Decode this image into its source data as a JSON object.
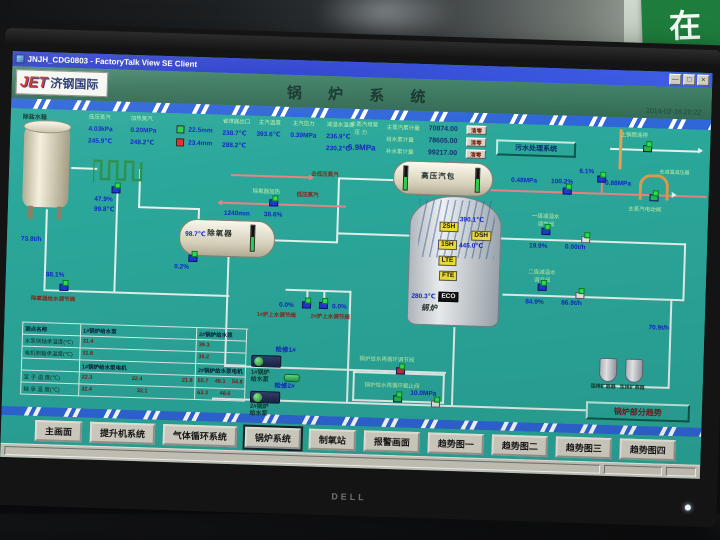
{
  "colors": {
    "teal_bg": "#2BA89B",
    "header_green": "#38755C",
    "titlebar_blue": "#2238D6",
    "stripe_blue": "#2F66D8",
    "value_blue": "#1226C8",
    "label_green": "#BDEEA6",
    "alarm_red": "#D03028",
    "ok_green": "#28D050"
  },
  "scene": {
    "wall_sign": "在",
    "monitor_brand": "DELL"
  },
  "window": {
    "title": "JNJH_CDG0803 - FactoryTalk View SE Client",
    "btn_min": "—",
    "btn_max": "□",
    "btn_close": "×"
  },
  "header": {
    "logo_main": "JET",
    "logo_sub": "济钢国际",
    "title": "锅 炉 系 统",
    "datetime": "2014-02-16 20:22"
  },
  "top": {
    "gA": {
      "l1": "低压蒸汽",
      "l2": "加热蒸汽",
      "p1": "4.03kPa",
      "p2": "0.20MPa",
      "t1": "245.9℃",
      "t2": "248.2℃"
    },
    "drumlevel": {
      "v1": "22.5mm",
      "v2": "23.4mm"
    },
    "gB": {
      "l1": "省煤器出口",
      "l2": "主汽温度",
      "l3": "主汽压力",
      "l4": "减温水温度",
      "v1": "238.7℃",
      "v1b": "288.2℃",
      "v2": "393.6℃",
      "v3": "0.39MPa",
      "v4": "236.9℃",
      "v4b": "230.2℃"
    },
    "main": {
      "label1": "主蒸汽母管",
      "label2": "压 力",
      "value": "6.9MPa"
    },
    "acc": [
      {
        "label": "主蒸汽累计量",
        "value": "70874.00",
        "btn": "清零"
      },
      {
        "label": "给水累计量",
        "value": "78605.00",
        "btn": "清零"
      },
      {
        "label": "补水累计量",
        "value": "99217.00",
        "btn": "清零"
      }
    ],
    "sewage_btn": "污水处理系统",
    "right_label": "上锅筒连排"
  },
  "left": {
    "tank_label": "除盐水箱",
    "tank_flow": "73.8t/h",
    "coil_pct": "47.9%",
    "coil_temp": "99.8℃",
    "feed_pct": "88.1%",
    "feed_label": "除氧器给水调节阀"
  },
  "deaerator": {
    "temp": "98.7℃",
    "name": "除氧器",
    "level": "1240mm",
    "pct": "38.6%",
    "vent": "0.2%",
    "steam1": "去低压蒸汽",
    "steam2a": "除氧器加热",
    "steam2b": "低压蒸汽"
  },
  "drum": {
    "name": "高压汽包"
  },
  "boiler": {
    "name": "锅炉",
    "tag_2sh": "2SH",
    "tag_dsh": "DSH",
    "tag_1sh": "1SH",
    "tag_lte": "LTE",
    "tag_fte": "FTE",
    "tag_eco": "ECO",
    "t_2sh": "390.1℃",
    "t_1sh": "445.0℃",
    "t_eco": "280.3℃"
  },
  "right": {
    "p1": "0.48MPa",
    "v1": "100.2%",
    "v2": "6.1%",
    "p2": "0.88MPa",
    "lbl_safety": "去减温减压器",
    "lbl_motor": "主蒸汽电动阀",
    "dsw1_lbl1": "一级减温水",
    "dsw1_lbl2": "调节阀",
    "dsw1_pct": "19.9%",
    "dsw1_flow": "0.00t/h",
    "dsw2_lbl1": "二级减温水",
    "dsw2_lbl2": "调节阀",
    "dsw2_pct": "84.9%",
    "dsw2_flow": "86.9t/h",
    "feed_flow": "70.9t/h"
  },
  "bottom": {
    "fv1_pct": "0.0%",
    "fv2_pct": "0.0%",
    "fv1_lbl": "1#炉上水调节阀",
    "fv2_lbl": "2#炉上水调节阀",
    "p1_status": "检修1#",
    "p2_status": "检修2#",
    "p1_lbl1": "1#锅炉",
    "p1_lbl2": "给水泵",
    "p2_lbl1": "2#锅炉",
    "p2_lbl2": "给水泵",
    "recirc1": "锅炉给水再循环调节阀",
    "recirc2": "锅炉给水再循环截止阀",
    "feed_p": "10.0MPa",
    "bd1": "连排扩容器",
    "bd2": "定排扩容器"
  },
  "table": {
    "h": [
      "测点名称",
      "1#锅炉给水泵",
      "2#锅炉给水泵"
    ],
    "r1": {
      "name": "水泵侧轴承温度(℃)",
      "a": "31.4",
      "b": "39.3"
    },
    "r2": {
      "name": "电机侧轴承温度(℃)",
      "a": "31.8",
      "b": "39.2"
    },
    "sh": {
      "a": "1#锅炉给水泵电机",
      "b": "2#锅炉给水泵电机"
    },
    "r3": {
      "name": "定 子 温 度(℃)",
      "a1": "22.3",
      "a2": "22.4",
      "a3": "21.8",
      "b1": "55.7",
      "b2": "49.1",
      "b3": "54.8"
    },
    "r4": {
      "name": "轴 承 温 度(℃)",
      "a1": "32.4",
      "a2": "32.1",
      "a3": "",
      "b1": "63.3",
      "b2": "48.6",
      "b3": ""
    }
  },
  "trend_btn": "锅炉部分趋势",
  "nav": [
    "主画面",
    "提升机系统",
    "气体循环系统",
    "锅炉系统",
    "制氧站",
    "报警画面",
    "趋势图一",
    "趋势图二",
    "趋势图三",
    "趋势图四"
  ],
  "nav_active_index": 3
}
